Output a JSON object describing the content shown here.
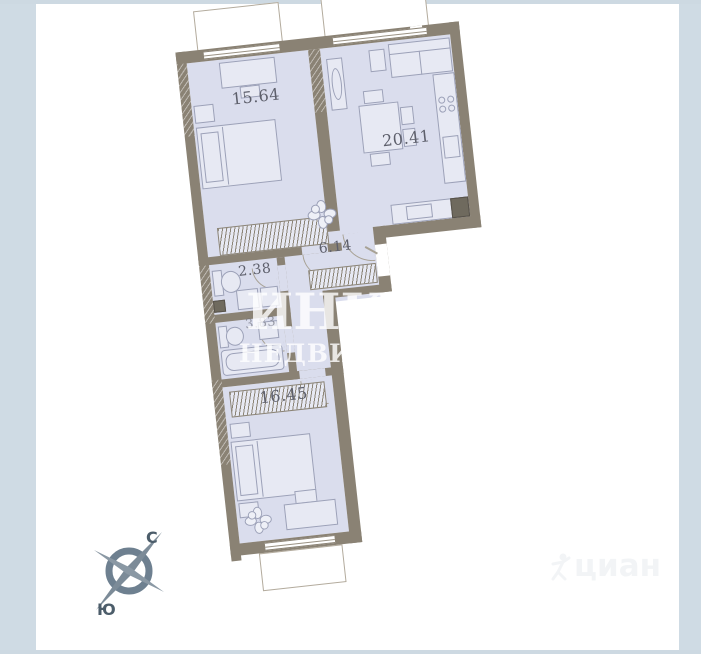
{
  "plan": {
    "rooms": {
      "bedroom1_area": "15.64",
      "living_area": "20.41",
      "wc_area": "2.38",
      "hall_area": "6.14",
      "bathroom_area": "3.83",
      "bedroom2_area": "16.45"
    }
  },
  "watermarks": {
    "main_part1": "ИНК",
    "main_part2": "М",
    "main_line2": "НЕДВИЖИМОСТЬ",
    "secondary": "циан"
  },
  "compass": {
    "north": "С",
    "south": "Ю"
  },
  "colors": {
    "wall": "#8a8274",
    "room_fill": "#dadded",
    "frame": "#cdd9e2",
    "compass": "#7c8b98"
  }
}
